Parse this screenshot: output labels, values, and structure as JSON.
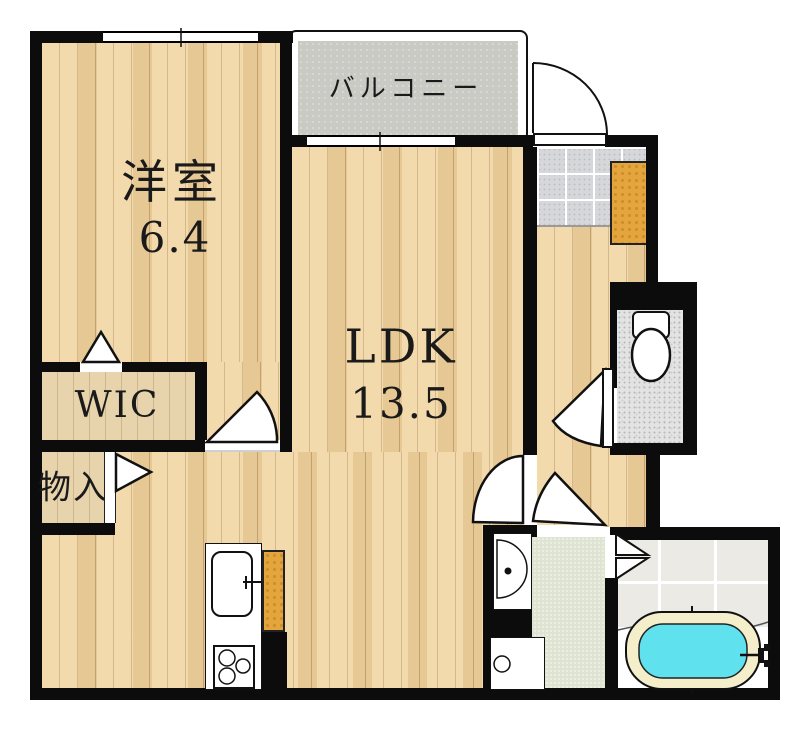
{
  "plan": {
    "rooms": [
      {
        "id": "western-room",
        "label": "洋室",
        "size": "6.4"
      },
      {
        "id": "ldk",
        "label": "LDK",
        "size": "13.5"
      },
      {
        "id": "walk-in-closet",
        "label": "WIC",
        "size": ""
      },
      {
        "id": "storage",
        "label": "物入",
        "size": ""
      },
      {
        "id": "balcony",
        "label": "バルコニー",
        "size": ""
      }
    ],
    "fixtures": [
      "entry-door",
      "shoe-cabinet",
      "toilet",
      "bathtub",
      "washbasin",
      "washing-machine-pan",
      "kitchen-sink",
      "gas-stove"
    ],
    "colors": {
      "wall": "#0c0c0c",
      "wood_floor": "#eed2a0",
      "closet_floor": "#e7d3ac",
      "balcony_floor": "#c9cac3",
      "genkan_tile": "#d6d7da",
      "toilet_floor": "#e3e3e3",
      "washroom_floor": "#dfe4d2",
      "bath_tile": "#eceae5",
      "bathtub_rim": "#f4eecb",
      "bathtub_water": "#5fe2ee",
      "cabinet": "#e5a53d"
    }
  }
}
